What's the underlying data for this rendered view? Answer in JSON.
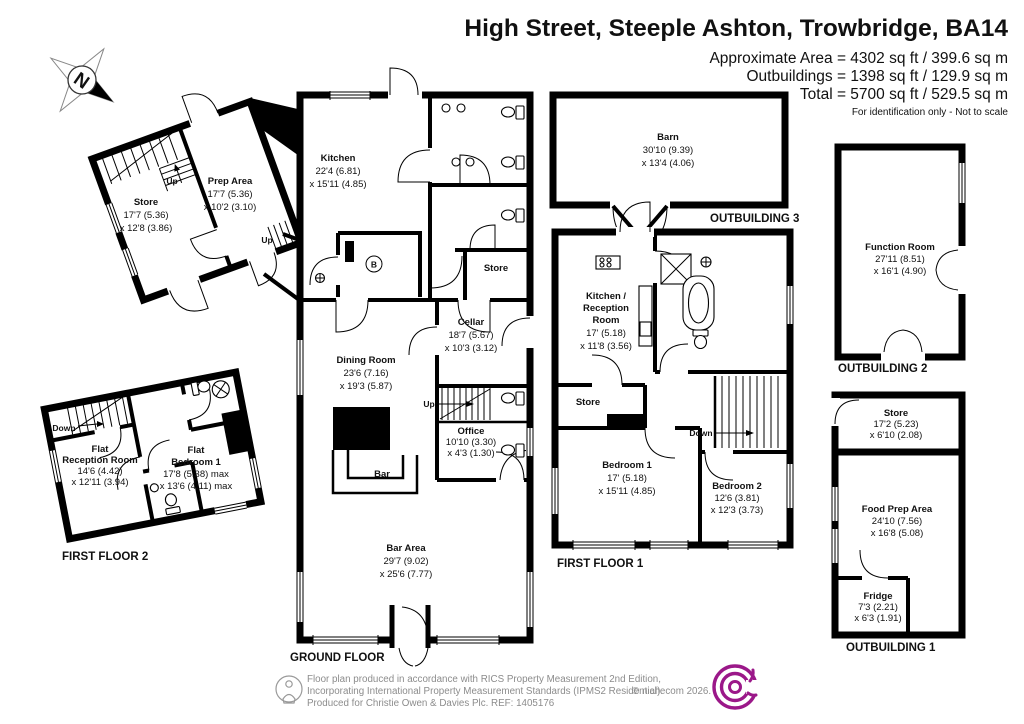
{
  "title": "High Street, Steeple Ashton, Trowbridge, BA14",
  "header": {
    "approx_area": "Approximate Area = 4302 sq ft / 399.6 sq m",
    "outbuildings": "Outbuildings = 1398 sq ft / 129.9 sq m",
    "total": "Total = 5700 sq ft / 529.5 sq m",
    "disclaimer": "For identification only - Not to scale"
  },
  "compass": {
    "north": "N"
  },
  "stairs": {
    "up": "Up",
    "down": "Down"
  },
  "boiler": "B",
  "floor_labels": {
    "ground_floor": "GROUND FLOOR",
    "first_floor_1": "FIRST FLOOR 1",
    "first_floor_2": "FIRST FLOOR 2",
    "outbuilding_1": "OUTBUILDING 1",
    "outbuilding_2": "OUTBUILDING 2",
    "outbuilding_3": "OUTBUILDING 3"
  },
  "rooms": {
    "annex_store": {
      "name": "Store",
      "d1": "17'7 (5.36)",
      "d2": "x 12'8 (3.86)"
    },
    "prep_area": {
      "name": "Prep Area",
      "d1": "17'7 (5.36)",
      "d2": "x 10'2 (3.10)"
    },
    "kitchen": {
      "name": "Kitchen",
      "d1": "22'4 (6.81)",
      "d2": "x 15'11 (4.85)"
    },
    "gf_store": {
      "name": "Store"
    },
    "cellar": {
      "name": "Cellar",
      "d1": "18'7 (5.67)",
      "d2": "x 10'3 (3.12)"
    },
    "dining_room": {
      "name": "Dining Room",
      "d1": "23'6 (7.16)",
      "d2": "x 19'3 (5.87)"
    },
    "office": {
      "name": "Office",
      "d1": "10'10 (3.30)",
      "d2": "x 4'3 (1.30)"
    },
    "bar": {
      "name": "Bar"
    },
    "bar_area": {
      "name": "Bar Area",
      "d1": "29'7 (9.02)",
      "d2": "x 25'6 (7.77)"
    },
    "barn": {
      "name": "Barn",
      "d1": "30'10 (9.39)",
      "d2": "x 13'4 (4.06)"
    },
    "kitchen_reception": {
      "l1": "Kitchen /",
      "l2": "Reception",
      "l3": "Room",
      "d1": "17' (5.18)",
      "d2": "x 11'8 (3.56)"
    },
    "ff1_store": {
      "name": "Store"
    },
    "bedroom_1": {
      "name": "Bedroom 1",
      "d1": "17' (5.18)",
      "d2": "x 15'11 (4.85)"
    },
    "bedroom_2": {
      "name": "Bedroom 2",
      "d1": "12'6 (3.81)",
      "d2": "x 12'3 (3.73)"
    },
    "flat_reception": {
      "l1": "Flat",
      "l2": "Reception Room",
      "d1": "14'6 (4.42)",
      "d2": "x 12'11 (3.94)"
    },
    "flat_bedroom_1": {
      "l1": "Flat",
      "l2": "Bedroom 1",
      "d1": "17'8 (5.38) max",
      "d2": "x 13'6 (4.11) max"
    },
    "function_room": {
      "name": "Function Room",
      "d1": "27'11 (8.51)",
      "d2": "x 16'1 (4.90)"
    },
    "ob1_store": {
      "name": "Store",
      "d1": "17'2 (5.23)",
      "d2": "x 6'10 (2.08)"
    },
    "food_prep": {
      "name": "Food Prep Area",
      "d1": "24'10 (7.56)",
      "d2": "x 16'8 (5.08)"
    },
    "fridge": {
      "name": "Fridge",
      "d1": "7'3 (2.21)",
      "d2": "x 6'3 (1.91)"
    }
  },
  "footer": {
    "line1": "Floor plan produced in accordance with RICS Property Measurement 2nd Edition,",
    "line2": "Incorporating International Property Measurement Standards (IPMS2 Residential).",
    "copyright": "© nichecom 2026.",
    "line3": "Produced for Christie Owen & Davies Plc.    REF: 1405176"
  },
  "colors": {
    "wall": "#000000",
    "logo_purple": "#9b1889",
    "footer_gray": "#8c8c8c"
  }
}
